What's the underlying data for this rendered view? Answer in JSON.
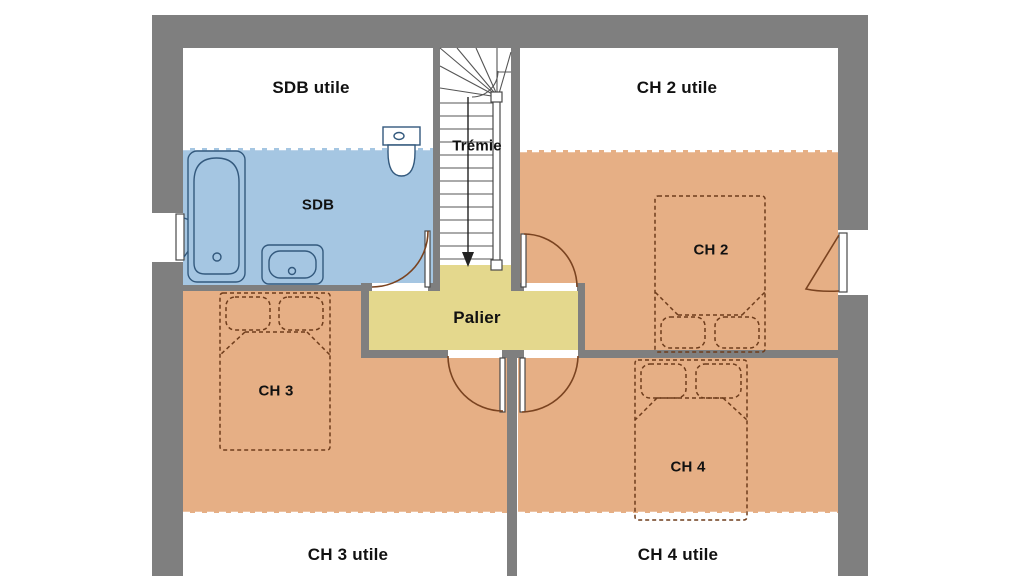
{
  "floor_plan": {
    "title": "Plan d'étage",
    "labels": {
      "sdb_utile": "SDB utile",
      "ch2_utile": "CH 2 utile",
      "tremie": "Trémie",
      "sdb": "SDB",
      "palier": "Palier",
      "ch2": "CH 2",
      "ch3": "CH 3",
      "ch4": "CH 4",
      "ch3_utile": "CH 3 utile",
      "ch4_utile": "CH 4 utile"
    },
    "colors": {
      "wall": "#7f7f7f",
      "bathroom": "#a5c6e2",
      "bedroom": "#e6af85",
      "landing": "#e4d88d",
      "fixture_line": "#33597d",
      "door_line": "#7a4320",
      "bed_line": "#6f3d1c",
      "stair_line": "#555555",
      "text": "#111111",
      "background": "#ffffff"
    }
  }
}
